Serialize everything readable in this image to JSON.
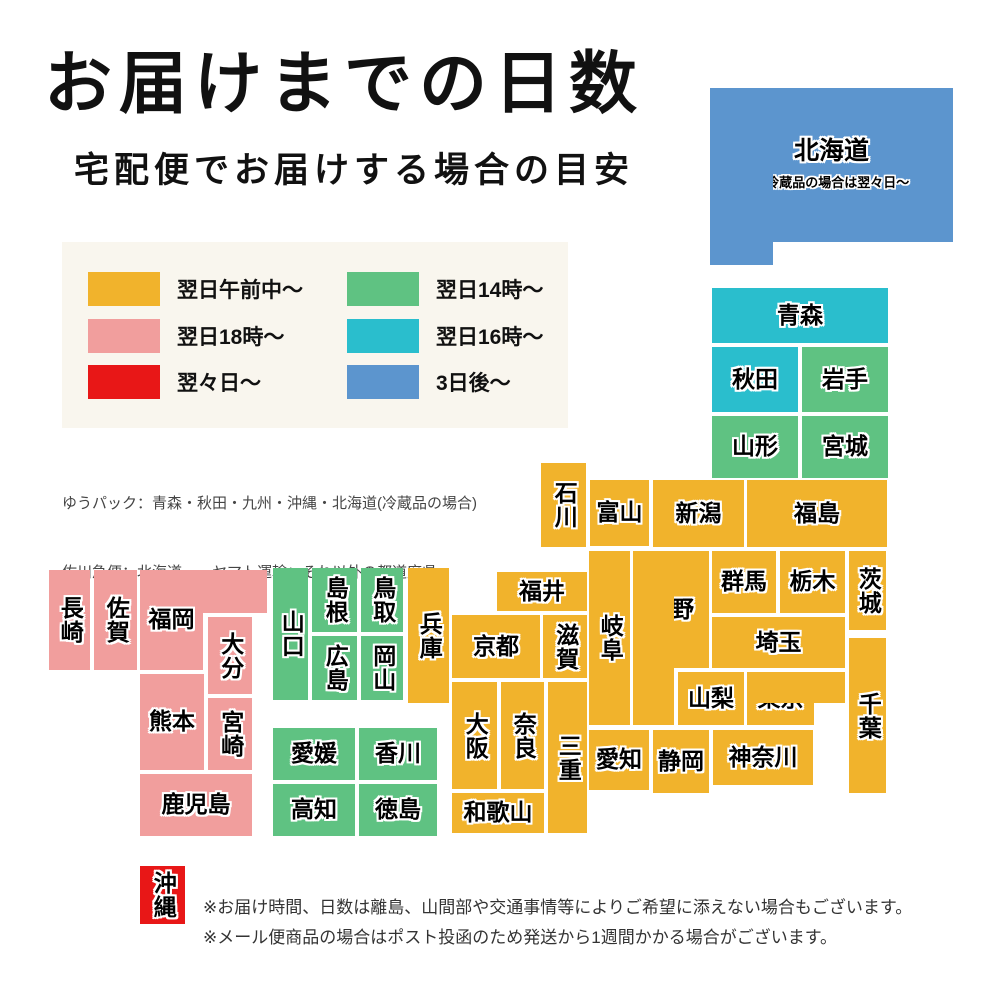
{
  "title": "お届けまでの日数",
  "subtitle": "宅配便でお届けする場合の目安",
  "colors": {
    "yellow": "#F1B32C",
    "pink": "#F19E9D",
    "red": "#E81717",
    "green": "#5FC282",
    "teal": "#2ABECD",
    "blue": "#5C95CE",
    "legend_bg": "#F9F6EE"
  },
  "legend": {
    "items": [
      {
        "label": "翌日午前中〜",
        "color": "yellow"
      },
      {
        "label": "翌日14時〜",
        "color": "green"
      },
      {
        "label": "翌日18時〜",
        "color": "pink"
      },
      {
        "label": "翌日16時〜",
        "color": "teal"
      },
      {
        "label": "翌々日〜",
        "color": "red"
      },
      {
        "label": "3日後〜",
        "color": "blue"
      }
    ]
  },
  "carriers": [
    "ゆうパック：青森・秋田・九州・沖縄・北海道(冷蔵品の場合)",
    "佐川急便：北海道　　ヤマト運輸：それ以外の都道府県"
  ],
  "map": {
    "tiles": [
      {
        "id": "hokkaido",
        "label": "北海道",
        "color": "blue",
        "font": 25,
        "note": "※冷蔵品の場合は翌々日〜",
        "rects": [
          [
            710,
            88,
            243,
            154
          ],
          [
            710,
            88,
            63,
            177
          ]
        ],
        "label_in": 0
      },
      {
        "id": "aomori",
        "label": "青森",
        "color": "teal",
        "rects": [
          [
            712,
            288,
            176,
            55
          ]
        ]
      },
      {
        "id": "akita",
        "label": "秋田",
        "color": "teal",
        "rects": [
          [
            712,
            347,
            86,
            65
          ]
        ]
      },
      {
        "id": "iwate",
        "label": "岩手",
        "color": "green",
        "rects": [
          [
            802,
            347,
            86,
            65
          ]
        ]
      },
      {
        "id": "yamagata",
        "label": "山形",
        "color": "green",
        "rects": [
          [
            712,
            416,
            86,
            62
          ]
        ]
      },
      {
        "id": "miyagi",
        "label": "宮城",
        "color": "green",
        "rects": [
          [
            802,
            416,
            86,
            62
          ]
        ]
      },
      {
        "id": "niigata",
        "label": "新潟",
        "color": "yellow",
        "rects": [
          [
            653,
            480,
            91,
            67
          ]
        ]
      },
      {
        "id": "fukushima",
        "label": "福島",
        "color": "yellow",
        "rects": [
          [
            747,
            480,
            140,
            67
          ]
        ]
      },
      {
        "id": "toyama",
        "label": "富山",
        "color": "yellow",
        "rects": [
          [
            590,
            480,
            59,
            66
          ]
        ]
      },
      {
        "id": "ishikawa",
        "label": "石川",
        "color": "yellow",
        "v": true,
        "rects": [
          [
            541,
            463,
            45,
            84
          ]
        ]
      },
      {
        "id": "fukui",
        "label": "福井",
        "color": "yellow",
        "rects": [
          [
            497,
            572,
            90,
            39
          ]
        ]
      },
      {
        "id": "gunma",
        "label": "群馬",
        "color": "yellow",
        "rects": [
          [
            712,
            551,
            64,
            62
          ]
        ]
      },
      {
        "id": "tochigi",
        "label": "栃木",
        "color": "yellow",
        "rects": [
          [
            780,
            551,
            65,
            62
          ]
        ]
      },
      {
        "id": "ibaraki",
        "label": "茨城",
        "color": "yellow",
        "v": true,
        "rects": [
          [
            849,
            551,
            37,
            79
          ]
        ]
      },
      {
        "id": "saitama",
        "label": "埼玉",
        "color": "yellow",
        "rects": [
          [
            712,
            617,
            133,
            51
          ]
        ]
      },
      {
        "id": "nagano",
        "label": "長野",
        "color": "yellow",
        "rects": [
          [
            633,
            551,
            76,
            117
          ],
          [
            633,
            551,
            41,
            174
          ]
        ],
        "label_in": 0
      },
      {
        "id": "gifu",
        "label": "岐阜",
        "color": "yellow",
        "v": true,
        "rects": [
          [
            589,
            551,
            41,
            174
          ]
        ]
      },
      {
        "id": "yamanashi",
        "label": "山梨",
        "color": "yellow",
        "rects": [
          [
            678,
            672,
            66,
            53
          ]
        ]
      },
      {
        "id": "tokyo",
        "label": "東京",
        "color": "yellow",
        "rects": [
          [
            747,
            672,
            67,
            53
          ],
          [
            747,
            672,
            98,
            31
          ]
        ],
        "label_in": 0
      },
      {
        "id": "chiba",
        "label": "千葉",
        "color": "yellow",
        "v": true,
        "rects": [
          [
            849,
            638,
            37,
            155
          ]
        ]
      },
      {
        "id": "shiga",
        "label": "滋賀",
        "color": "yellow",
        "v": true,
        "rects": [
          [
            543,
            615,
            44,
            63
          ]
        ]
      },
      {
        "id": "kyoto",
        "label": "京都",
        "color": "yellow",
        "rects": [
          [
            452,
            615,
            88,
            63
          ]
        ]
      },
      {
        "id": "hyogo",
        "label": "兵庫",
        "color": "yellow",
        "v": true,
        "rects": [
          [
            408,
            568,
            41,
            135
          ]
        ]
      },
      {
        "id": "osaka",
        "label": "大阪",
        "color": "yellow",
        "v": true,
        "rects": [
          [
            452,
            682,
            45,
            107
          ]
        ]
      },
      {
        "id": "nara",
        "label": "奈良",
        "color": "yellow",
        "v": true,
        "rects": [
          [
            501,
            682,
            43,
            107
          ]
        ]
      },
      {
        "id": "mie",
        "label": "三重",
        "color": "yellow",
        "v": true,
        "rects": [
          [
            548,
            682,
            39,
            151
          ]
        ]
      },
      {
        "id": "wakayama",
        "label": "和歌山",
        "color": "yellow",
        "rects": [
          [
            452,
            793,
            92,
            40
          ]
        ]
      },
      {
        "id": "aichi",
        "label": "愛知",
        "color": "yellow",
        "rects": [
          [
            589,
            730,
            60,
            60
          ]
        ]
      },
      {
        "id": "shizuoka",
        "label": "静岡",
        "color": "yellow",
        "rects": [
          [
            653,
            730,
            56,
            63
          ]
        ]
      },
      {
        "id": "kanagawa",
        "label": "神奈川",
        "color": "yellow",
        "rects": [
          [
            713,
            730,
            100,
            55
          ]
        ]
      },
      {
        "id": "yamaguchi",
        "label": "山口",
        "color": "green",
        "v": true,
        "rects": [
          [
            273,
            568,
            35,
            132
          ]
        ]
      },
      {
        "id": "shimane",
        "label": "島根",
        "color": "green",
        "v": true,
        "rects": [
          [
            312,
            568,
            45,
            64
          ]
        ]
      },
      {
        "id": "tottori",
        "label": "鳥取",
        "color": "green",
        "v": true,
        "rects": [
          [
            361,
            568,
            42,
            64
          ]
        ]
      },
      {
        "id": "hiroshima",
        "label": "広島",
        "color": "green",
        "v": true,
        "rects": [
          [
            312,
            636,
            45,
            64
          ]
        ]
      },
      {
        "id": "okayama",
        "label": "岡山",
        "color": "green",
        "v": true,
        "rects": [
          [
            361,
            636,
            42,
            64
          ]
        ]
      },
      {
        "id": "ehime",
        "label": "愛媛",
        "color": "green",
        "rects": [
          [
            273,
            728,
            82,
            52
          ]
        ]
      },
      {
        "id": "kagawa",
        "label": "香川",
        "color": "green",
        "rects": [
          [
            359,
            728,
            78,
            52
          ]
        ]
      },
      {
        "id": "kochi",
        "label": "高知",
        "color": "green",
        "rects": [
          [
            273,
            784,
            82,
            52
          ]
        ]
      },
      {
        "id": "tokushima",
        "label": "徳島",
        "color": "green",
        "rects": [
          [
            359,
            784,
            78,
            52
          ]
        ]
      },
      {
        "id": "nagasaki",
        "label": "長崎",
        "color": "pink",
        "v": true,
        "rects": [
          [
            49,
            570,
            41,
            100
          ]
        ]
      },
      {
        "id": "saga",
        "label": "佐賀",
        "color": "pink",
        "v": true,
        "rects": [
          [
            94,
            570,
            43,
            100
          ]
        ]
      },
      {
        "id": "fukuoka",
        "label": "福岡",
        "color": "pink",
        "rects": [
          [
            140,
            570,
            127,
            43
          ],
          [
            140,
            570,
            63,
            100
          ]
        ],
        "label_in": 1
      },
      {
        "id": "oita",
        "label": "大分",
        "color": "pink",
        "v": true,
        "rects": [
          [
            208,
            617,
            44,
            77
          ]
        ]
      },
      {
        "id": "kumamoto",
        "label": "熊本",
        "color": "pink",
        "rects": [
          [
            140,
            674,
            64,
            96
          ]
        ]
      },
      {
        "id": "miyazaki",
        "label": "宮崎",
        "color": "pink",
        "v": true,
        "rects": [
          [
            208,
            698,
            44,
            72
          ]
        ]
      },
      {
        "id": "kagoshima",
        "label": "鹿児島",
        "color": "pink",
        "rects": [
          [
            140,
            774,
            112,
            62
          ]
        ]
      },
      {
        "id": "okinawa",
        "label": "沖縄",
        "color": "red",
        "v": true,
        "rects": [
          [
            140,
            866,
            45,
            58
          ]
        ]
      }
    ]
  },
  "notes": [
    "※お届け時間、日数は離島、山間部や交通事情等によりご希望に添えない場合もございます。",
    "※メール便商品の場合はポスト投函のため発送から1週間かかる場合がございます。"
  ]
}
